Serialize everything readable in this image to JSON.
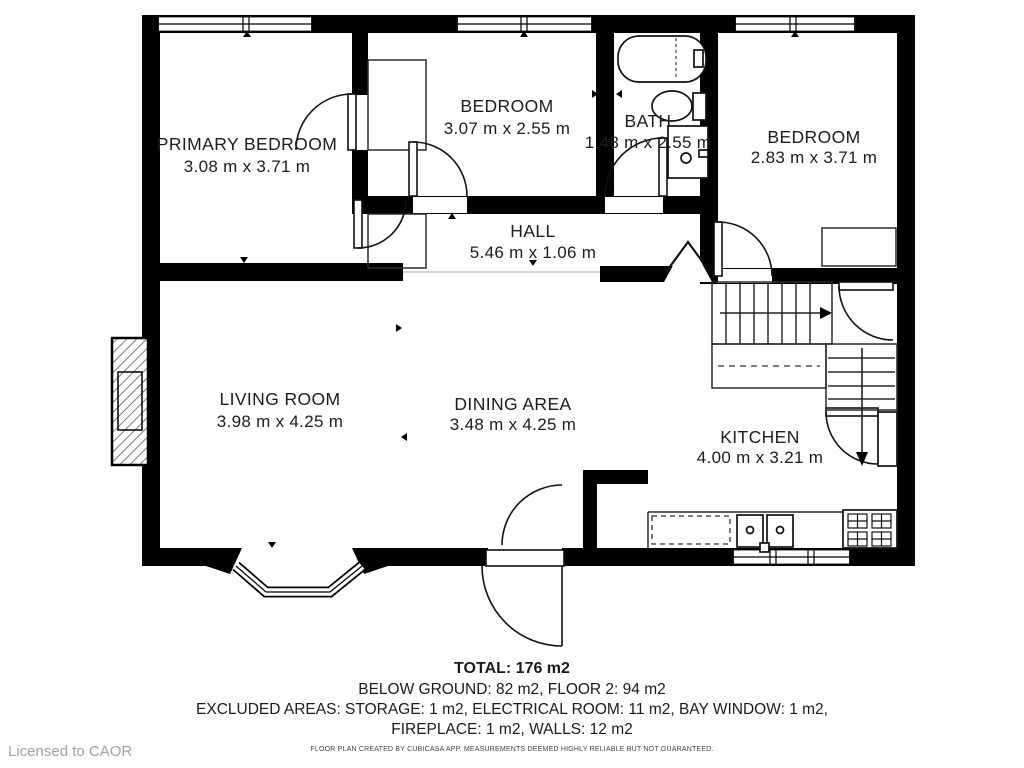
{
  "plan": {
    "rooms": [
      {
        "name": "PRIMARY BEDROOM",
        "dims": "3.08 m x 3.71 m"
      },
      {
        "name": "BEDROOM",
        "dims": "3.07 m x 2.55 m"
      },
      {
        "name": "BATH",
        "dims": "1.48 m x 2.55 m"
      },
      {
        "name": "BEDROOM",
        "dims": "2.83 m x 3.71 m"
      },
      {
        "name": "HALL",
        "dims": "5.46 m x 1.06 m"
      },
      {
        "name": "LIVING ROOM",
        "dims": "3.98 m x 4.25 m"
      },
      {
        "name": "DINING AREA",
        "dims": "3.48 m x 4.25 m"
      },
      {
        "name": "KITCHEN",
        "dims": "4.00 m x 3.21 m"
      }
    ]
  },
  "summary": {
    "total": "TOTAL: 176 m2",
    "floors": "BELOW GROUND: 82 m2, FLOOR 2: 94 m2",
    "excluded_1": "EXCLUDED AREAS: STORAGE: 1 m2, ELECTRICAL ROOM: 11 m2, BAY WINDOW: 1 m2,",
    "excluded_2": "FIREPLACE: 1 m2, WALLS: 12 m2",
    "disclaimer": "FLOOR PLAN CREATED BY CUBICASA APP. MEASUREMENTS DEEMED HIGHLY RELIABLE BUT NOT GUARANTEED."
  },
  "license": "Licensed to CAOR",
  "colors": {
    "wall": "#000000",
    "text": "#1b1b1b",
    "muted": "#9aa3ab",
    "background": "#ffffff"
  }
}
